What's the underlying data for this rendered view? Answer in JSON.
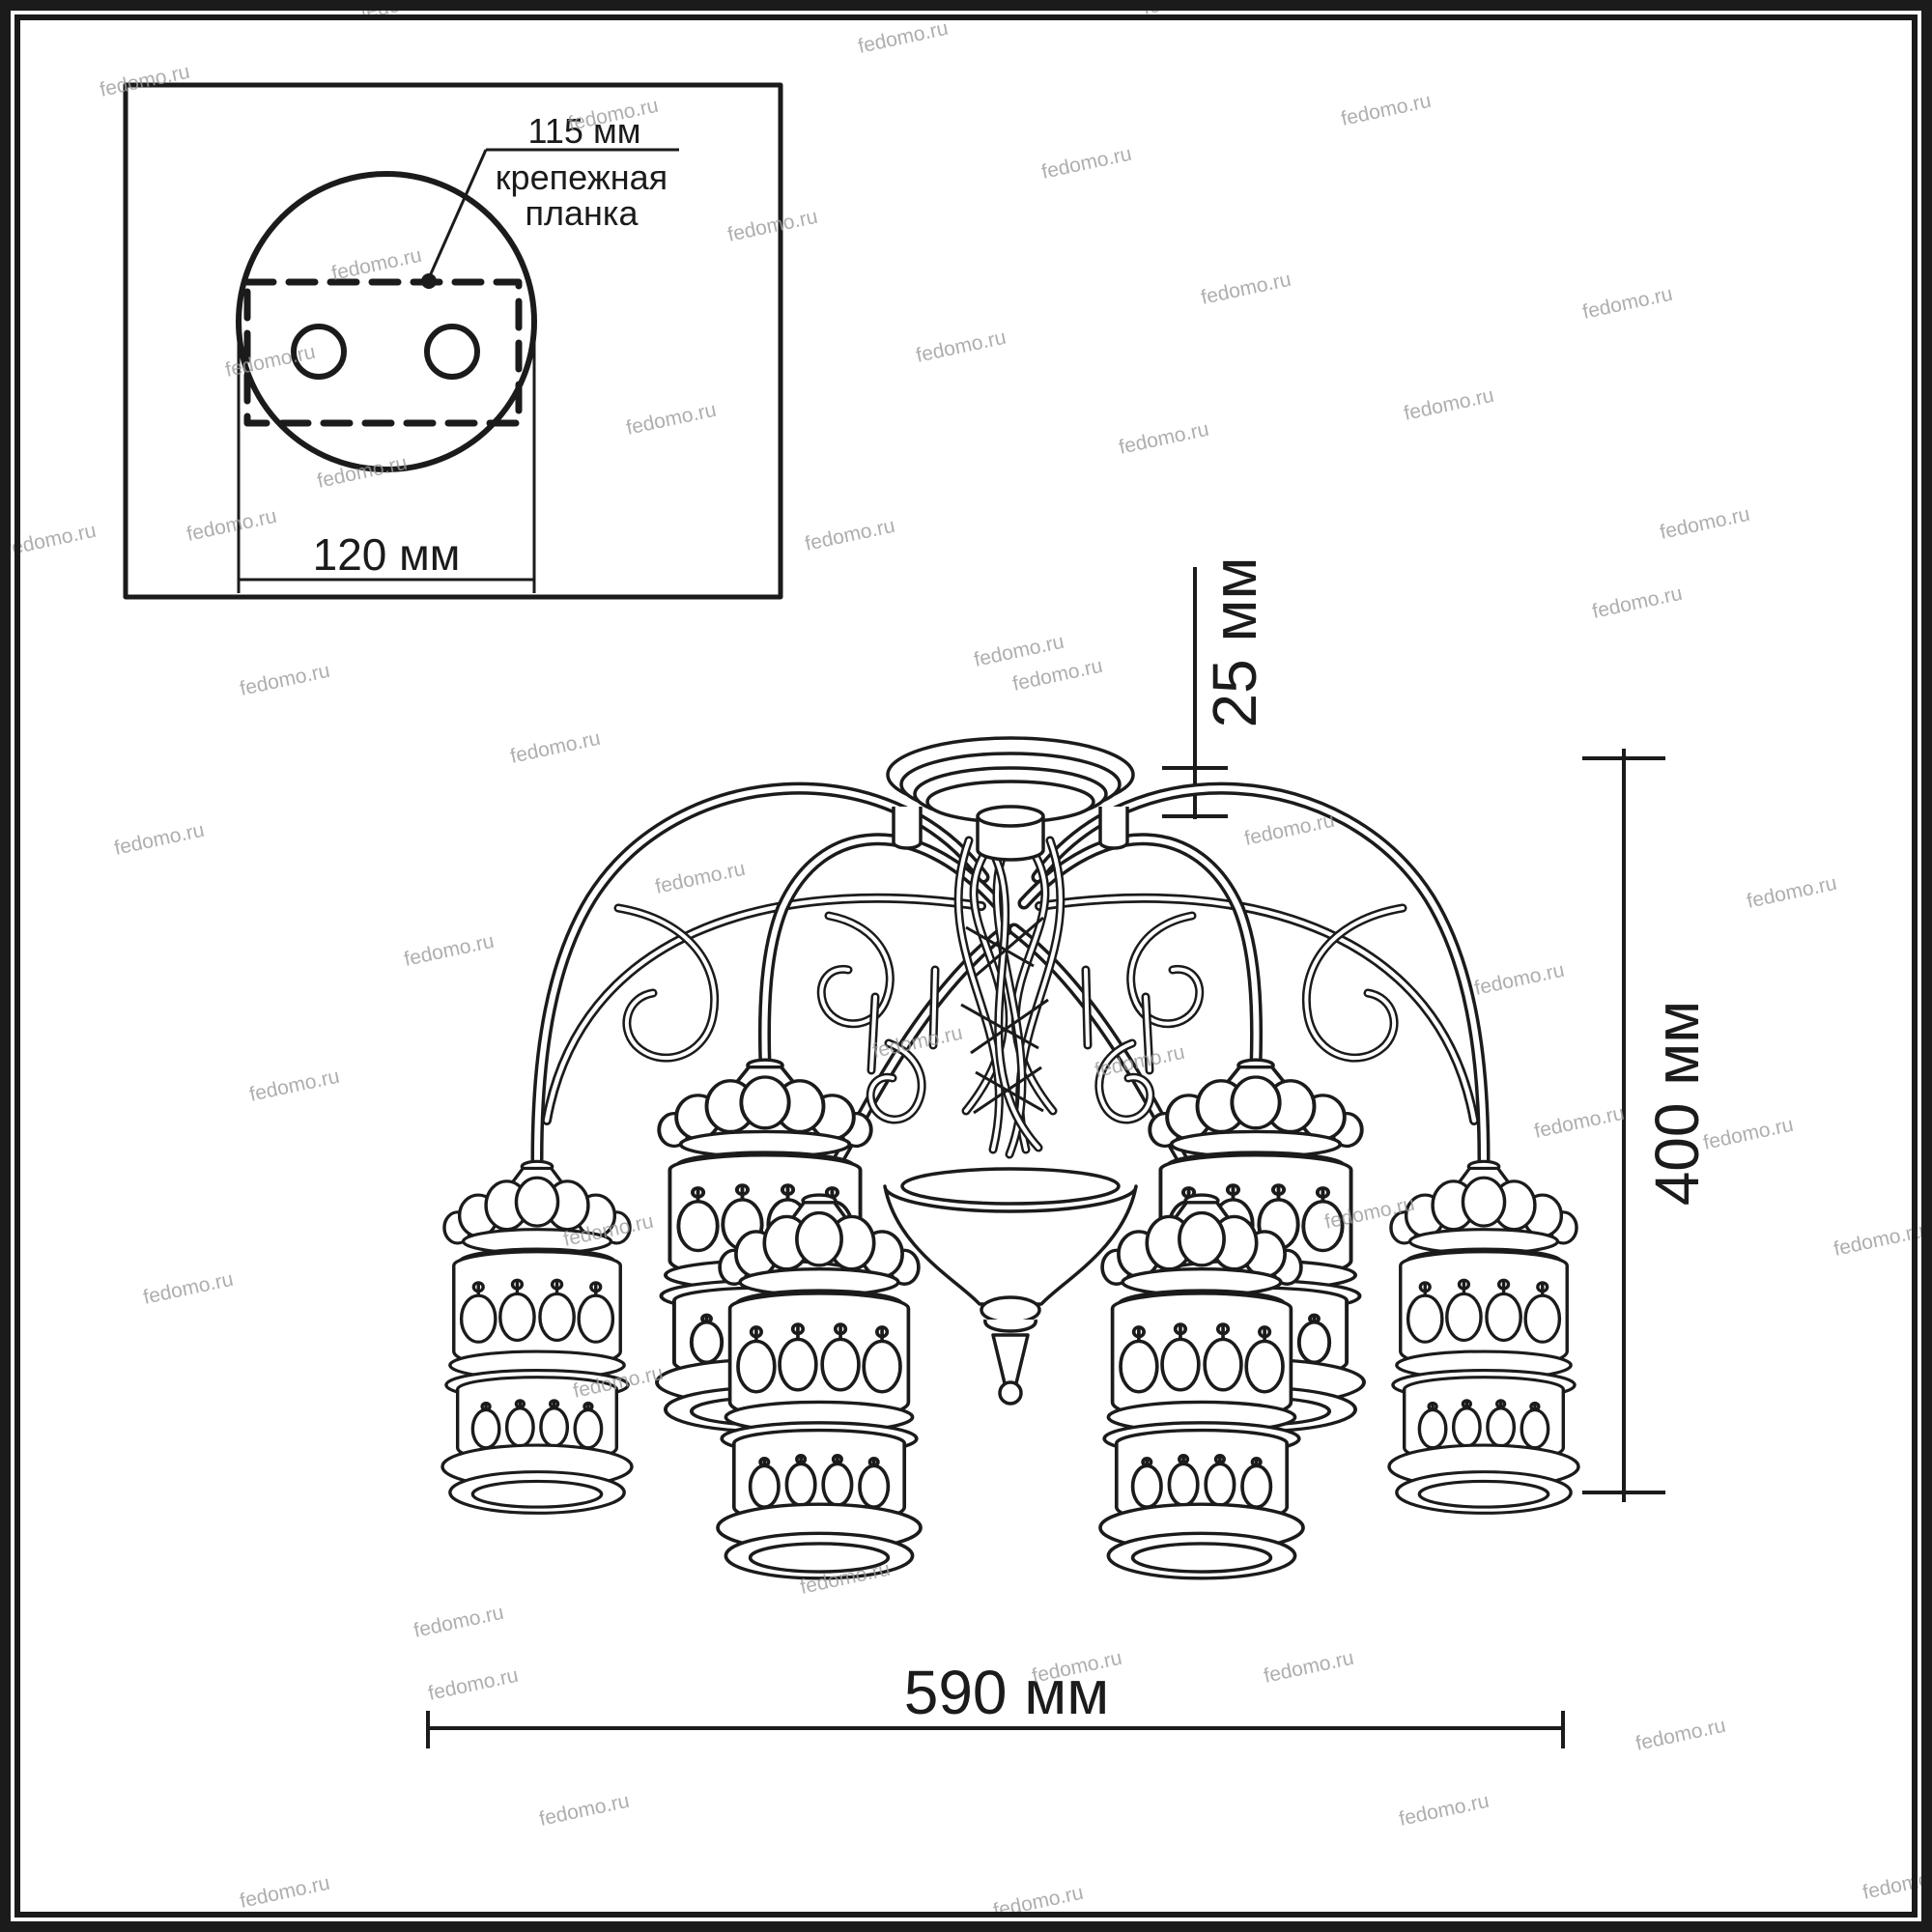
{
  "colors": {
    "line": "#1b1b1b",
    "background": "#ffffff",
    "watermark": "#9b9b9b"
  },
  "inset": {
    "bracket_width_label": "115 мм",
    "bracket_name_line1": "крепежная",
    "bracket_name_line2": "планка",
    "base_diameter_label": "120 мм"
  },
  "dimensions": {
    "canopy_height": "25 мм",
    "fixture_height": "400 мм",
    "fixture_width": "590 мм"
  },
  "watermark": {
    "text": "fedomo.ru",
    "rotation": -12,
    "positions": [
      [
        375,
        20
      ],
      [
        890,
        55
      ],
      [
        1185,
        15
      ],
      [
        1468,
        10
      ],
      [
        105,
        100
      ],
      [
        590,
        135
      ],
      [
        1390,
        130
      ],
      [
        1080,
        185
      ],
      [
        755,
        250
      ],
      [
        345,
        290
      ],
      [
        1245,
        315
      ],
      [
        1640,
        330
      ],
      [
        950,
        375
      ],
      [
        235,
        390
      ],
      [
        1455,
        435
      ],
      [
        650,
        450
      ],
      [
        1160,
        470
      ],
      [
        330,
        505
      ],
      [
        195,
        560
      ],
      [
        835,
        570
      ],
      [
        1720,
        558
      ],
      [
        8,
        575
      ],
      [
        1010,
        690
      ],
      [
        1650,
        640
      ],
      [
        250,
        720
      ],
      [
        1050,
        715
      ],
      [
        530,
        790
      ],
      [
        120,
        885
      ],
      [
        1290,
        875
      ],
      [
        680,
        925
      ],
      [
        1810,
        940
      ],
      [
        420,
        1000
      ],
      [
        1528,
        1030
      ],
      [
        905,
        1095
      ],
      [
        1135,
        1115
      ],
      [
        260,
        1140
      ],
      [
        1590,
        1178
      ],
      [
        1765,
        1190
      ],
      [
        585,
        1290
      ],
      [
        1373,
        1272
      ],
      [
        150,
        1350
      ],
      [
        1900,
        1300
      ],
      [
        595,
        1447
      ],
      [
        830,
        1650
      ],
      [
        445,
        1760
      ],
      [
        1695,
        1812
      ],
      [
        430,
        1695
      ],
      [
        1310,
        1742
      ],
      [
        1070,
        1742
      ],
      [
        560,
        1890
      ],
      [
        1450,
        1890
      ],
      [
        1930,
        1966
      ],
      [
        250,
        1975
      ],
      [
        1030,
        1985
      ]
    ]
  }
}
